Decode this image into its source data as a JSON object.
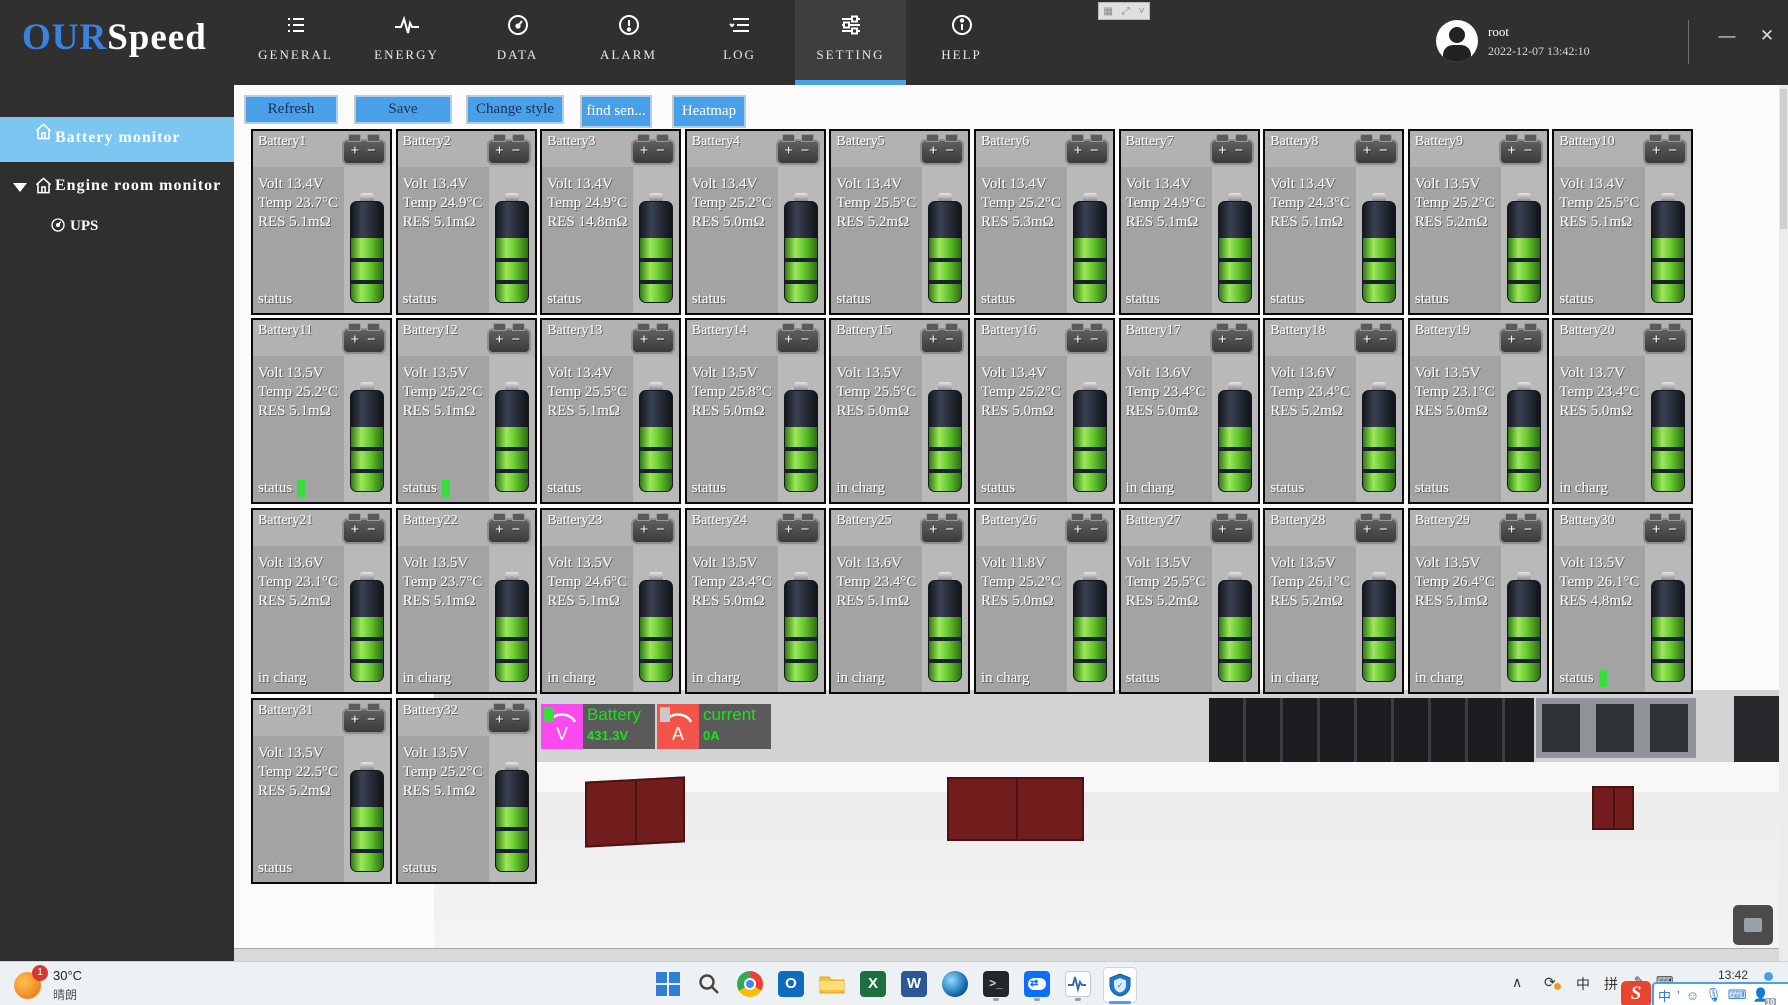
{
  "header": {
    "logo": {
      "our": "OUR",
      "speed": "Speed"
    },
    "nav": [
      {
        "label": "GENERAL",
        "icon": "list-icon",
        "active": false
      },
      {
        "label": "ENERGY",
        "icon": "pulse-icon",
        "active": false
      },
      {
        "label": "DATA",
        "icon": "gauge-icon",
        "active": false
      },
      {
        "label": "ALARM",
        "icon": "alarm-icon",
        "active": false
      },
      {
        "label": "LOG",
        "icon": "log-icon",
        "active": false
      },
      {
        "label": "SETTING",
        "icon": "sliders-icon",
        "active": true
      },
      {
        "label": "HELP",
        "icon": "info-icon",
        "active": false
      }
    ],
    "user": {
      "name": "root",
      "datetime": "2022-12-07 13:42:10"
    },
    "window": {
      "minimize": "—",
      "close": "✕"
    }
  },
  "sidebar": {
    "items": [
      {
        "label": "Battery monitor"
      },
      {
        "label": "Engine room monitor"
      },
      {
        "label": "UPS"
      }
    ]
  },
  "toolbar": {
    "buttons": [
      {
        "label": "Refresh",
        "x": 245,
        "w": 90,
        "lite": false
      },
      {
        "label": "Save",
        "x": 355,
        "w": 94,
        "lite": false
      },
      {
        "label": "Change style",
        "x": 467,
        "w": 94,
        "lite": false
      },
      {
        "label": "find sen...",
        "x": 581,
        "w": 68,
        "lite": true
      },
      {
        "label": "Heatmap",
        "x": 673,
        "w": 70,
        "lite": true
      }
    ]
  },
  "value_labels": {
    "volt": "Volt",
    "temp": "Temp",
    "res": "RES"
  },
  "batteries": [
    {
      "name": "Battery1",
      "volt": "13.4V",
      "temp": "23.7°C",
      "res": "5.1mΩ",
      "status": "status",
      "indicator": false
    },
    {
      "name": "Battery2",
      "volt": "13.4V",
      "temp": "24.9°C",
      "res": "5.1mΩ",
      "status": "status",
      "indicator": false
    },
    {
      "name": "Battery3",
      "volt": "13.4V",
      "temp": "24.9°C",
      "res": "14.8mΩ",
      "status": "status",
      "indicator": false
    },
    {
      "name": "Battery4",
      "volt": "13.4V",
      "temp": "25.2°C",
      "res": "5.0mΩ",
      "status": "status",
      "indicator": false
    },
    {
      "name": "Battery5",
      "volt": "13.4V",
      "temp": "25.5°C",
      "res": "5.2mΩ",
      "status": "status",
      "indicator": false
    },
    {
      "name": "Battery6",
      "volt": "13.4V",
      "temp": "25.2°C",
      "res": "5.3mΩ",
      "status": "status",
      "indicator": false
    },
    {
      "name": "Battery7",
      "volt": "13.4V",
      "temp": "24.9°C",
      "res": "5.1mΩ",
      "status": "status",
      "indicator": false
    },
    {
      "name": "Battery8",
      "volt": "13.4V",
      "temp": "24.3°C",
      "res": "5.1mΩ",
      "status": "status",
      "indicator": false
    },
    {
      "name": "Battery9",
      "volt": "13.5V",
      "temp": "25.2°C",
      "res": "5.2mΩ",
      "status": "status",
      "indicator": false
    },
    {
      "name": "Battery10",
      "volt": "13.4V",
      "temp": "25.5°C",
      "res": "5.1mΩ",
      "status": "status",
      "indicator": false
    },
    {
      "name": "Battery11",
      "volt": "13.5V",
      "temp": "25.2°C",
      "res": "5.1mΩ",
      "status": "status",
      "indicator": true
    },
    {
      "name": "Battery12",
      "volt": "13.5V",
      "temp": "25.2°C",
      "res": "5.1mΩ",
      "status": "status",
      "indicator": true
    },
    {
      "name": "Battery13",
      "volt": "13.4V",
      "temp": "25.5°C",
      "res": "5.1mΩ",
      "status": "status",
      "indicator": false
    },
    {
      "name": "Battery14",
      "volt": "13.5V",
      "temp": "25.8°C",
      "res": "5.0mΩ",
      "status": "status",
      "indicator": false
    },
    {
      "name": "Battery15",
      "volt": "13.5V",
      "temp": "25.5°C",
      "res": "5.0mΩ",
      "status": "in charg",
      "indicator": false
    },
    {
      "name": "Battery16",
      "volt": "13.4V",
      "temp": "25.2°C",
      "res": "5.0mΩ",
      "status": "status",
      "indicator": false
    },
    {
      "name": "Battery17",
      "volt": "13.6V",
      "temp": "23.4°C",
      "res": "5.0mΩ",
      "status": "in charg",
      "indicator": false
    },
    {
      "name": "Battery18",
      "volt": "13.6V",
      "temp": "23.4°C",
      "res": "5.2mΩ",
      "status": "status",
      "indicator": false
    },
    {
      "name": "Battery19",
      "volt": "13.5V",
      "temp": "23.1°C",
      "res": "5.0mΩ",
      "status": "status",
      "indicator": false
    },
    {
      "name": "Battery20",
      "volt": "13.7V",
      "temp": "23.4°C",
      "res": "5.0mΩ",
      "status": "in charg",
      "indicator": false
    },
    {
      "name": "Battery21",
      "volt": "13.6V",
      "temp": "23.1°C",
      "res": "5.2mΩ",
      "status": "in charg",
      "indicator": false
    },
    {
      "name": "Battery22",
      "volt": "13.5V",
      "temp": "23.7°C",
      "res": "5.1mΩ",
      "status": "in charg",
      "indicator": false
    },
    {
      "name": "Battery23",
      "volt": "13.5V",
      "temp": "24.6°C",
      "res": "5.1mΩ",
      "status": "in charg",
      "indicator": false
    },
    {
      "name": "Battery24",
      "volt": "13.5V",
      "temp": "23.4°C",
      "res": "5.0mΩ",
      "status": "in charg",
      "indicator": false
    },
    {
      "name": "Battery25",
      "volt": "13.6V",
      "temp": "23.4°C",
      "res": "5.1mΩ",
      "status": "in charg",
      "indicator": false
    },
    {
      "name": "Battery26",
      "volt": "11.8V",
      "temp": "25.2°C",
      "res": "5.0mΩ",
      "status": "in charg",
      "indicator": false
    },
    {
      "name": "Battery27",
      "volt": "13.5V",
      "temp": "25.5°C",
      "res": "5.2mΩ",
      "status": "status",
      "indicator": false
    },
    {
      "name": "Battery28",
      "volt": "13.5V",
      "temp": "26.1°C",
      "res": "5.2mΩ",
      "status": "in charg",
      "indicator": false
    },
    {
      "name": "Battery29",
      "volt": "13.5V",
      "temp": "26.4°C",
      "res": "5.1mΩ",
      "status": "in charg",
      "indicator": false
    },
    {
      "name": "Battery30",
      "volt": "13.5V",
      "temp": "26.1°C",
      "res": "4.8mΩ",
      "status": "status",
      "indicator": true
    },
    {
      "name": "Battery31",
      "volt": "13.5V",
      "temp": "22.5°C",
      "res": "5.2mΩ",
      "status": "status",
      "indicator": false
    },
    {
      "name": "Battery32",
      "volt": "13.5V",
      "temp": "25.2°C",
      "res": "5.1mΩ",
      "status": "status",
      "indicator": false
    }
  ],
  "overlay": {
    "voltage": {
      "title": "Battery",
      "value": "431.3V",
      "box_color": "#fb49f0"
    },
    "current": {
      "title": "current",
      "value": "0A",
      "box_color": "#f2544a"
    }
  },
  "taskbar": {
    "weather": {
      "badge": "1",
      "temp": "30°C",
      "desc": "晴朗"
    },
    "apps": [
      "windows-start",
      "search",
      "chrome",
      "outlook",
      "file-explorer",
      "excel",
      "word",
      "edge",
      "terminal",
      "teamviewer",
      "monitor",
      "security-shield"
    ],
    "tray": {
      "lang1": "中",
      "lang2": "拼",
      "time": "13:42"
    },
    "ime": {
      "logo": "S",
      "mode": "中",
      "punct": "’",
      "badge": "10"
    }
  },
  "colors": {
    "accent_blue": "#4aa0e8",
    "sidebar_active": "#7cc7f2",
    "battery_green": "#64c32d",
    "status_green": "#35e03a"
  }
}
